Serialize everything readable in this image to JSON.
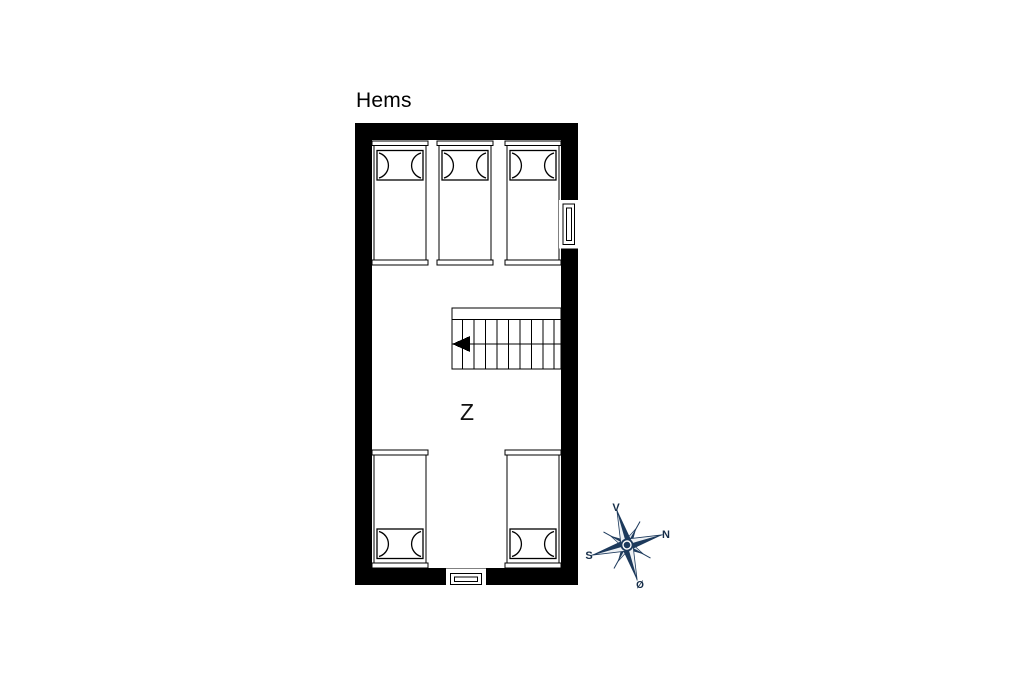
{
  "title": "Hems",
  "floor_plan": {
    "room_label": "Z",
    "wall_color": "#000000",
    "floor_color": "#ffffff",
    "line_color": "#000000",
    "beds": {
      "top_row_count": 3,
      "bottom_row_count": 2
    },
    "stairs": {
      "arrow_direction": "left"
    },
    "windows": [
      "east-wall-window",
      "south-wall-window"
    ]
  },
  "compass": {
    "color": "#1d3a5c",
    "light_color": "#e3e8ed",
    "label_west": "V",
    "label_north": "N",
    "label_south": "S",
    "label_east": "Ø"
  }
}
